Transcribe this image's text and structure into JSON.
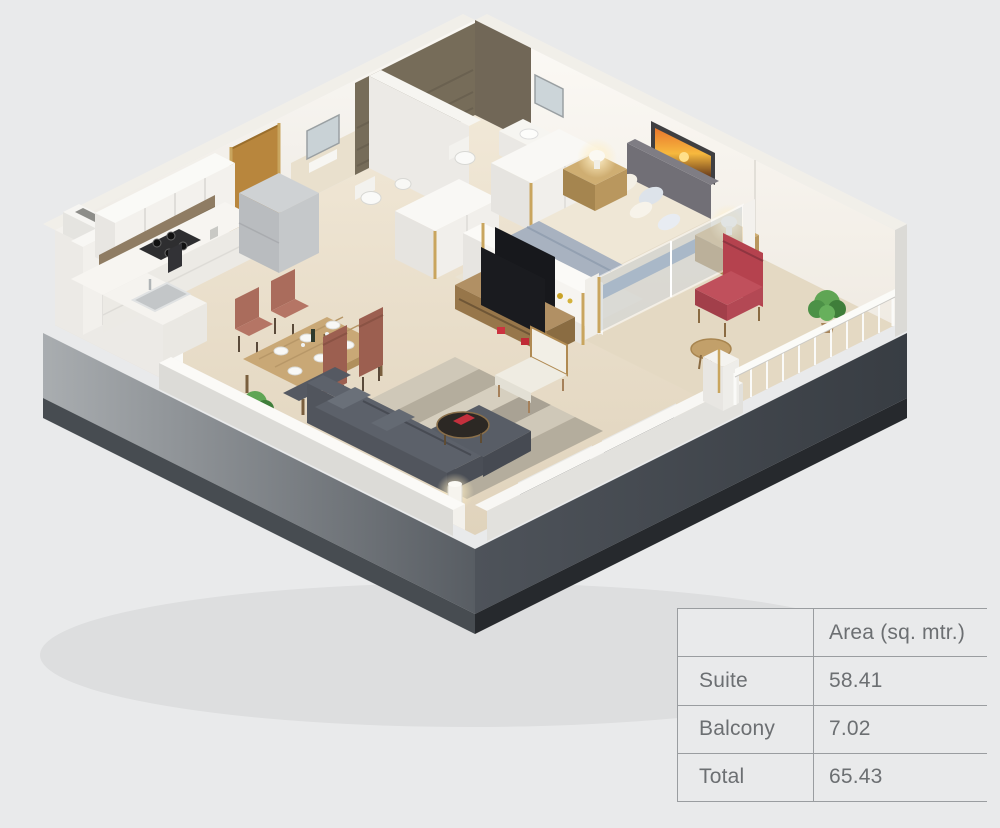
{
  "page": {
    "background_color": "#e9eaeb",
    "description": "3D isometric dollhouse render of a one-bedroom suite with balcony; area table at bottom right"
  },
  "area_table": {
    "header": {
      "row_label_column": "",
      "area_column": "Area (sq. mtr.)"
    },
    "rows": [
      {
        "label": "Suite",
        "value": "58.41"
      },
      {
        "label": "Balcony",
        "value": "7.02"
      },
      {
        "label": "Total",
        "value": "65.43"
      }
    ],
    "text_color": "#6c6f72",
    "border_color": "#9a9da0"
  },
  "floorplan": {
    "view": "isometric-3d-cutaway",
    "rooms": [
      "kitchen",
      "dining-area",
      "living-room",
      "hallway",
      "bathroom-1",
      "bathroom-2",
      "bedroom",
      "balcony"
    ],
    "furniture": [
      "kitchen-cabinets",
      "cooktop",
      "kitchen-sink",
      "refrigerator-box",
      "entrance-door",
      "dining-table",
      "dining-chairs",
      "sofa",
      "coffee-table",
      "armchair",
      "floor-lamp",
      "tv-console",
      "wall-tv",
      "double-bed",
      "headboard",
      "nightstands",
      "table-lamps",
      "sunset-wall-art",
      "wardrobes",
      "toilets",
      "wash-basins",
      "mirrors",
      "shower-tile-walls",
      "balcony-armchair",
      "balcony-round-table",
      "potted-plants",
      "balcony-railing",
      "window-glass"
    ],
    "colors": {
      "floor": "#e8dcc6",
      "walls": "#f5f3ee",
      "base_dark": "#42474d",
      "accent_red": "#b5424e",
      "sofa_gray": "#565b63",
      "wood": "#b8924f",
      "window_glass": "#22262b",
      "bed_frame_blue": "#7e97b5",
      "tile_brown": "#766c59"
    }
  }
}
